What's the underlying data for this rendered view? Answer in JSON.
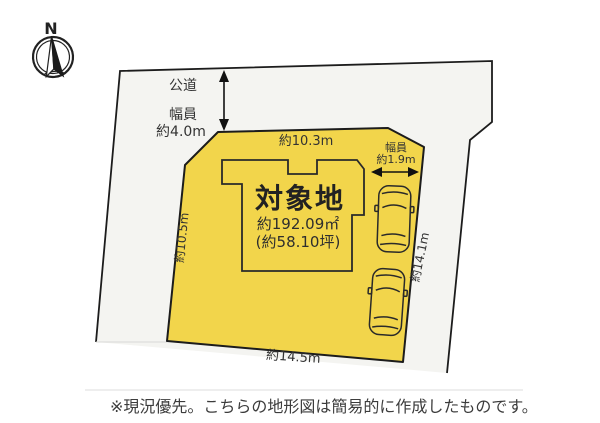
{
  "compass": {
    "north_label": "N"
  },
  "road_top": {
    "name": "公道",
    "width_caption_line1": "幅員",
    "width_caption_line2": "約4.0m"
  },
  "plot": {
    "label": "対象地",
    "area_m2": "約192.09㎡",
    "area_tsubo": "(約58.10坪)",
    "top_dim": "約10.3m",
    "left_dim": "約10.5m",
    "right_dim": "約14.1m",
    "bottom_dim": "約14.5m"
  },
  "side_passage": {
    "width_caption_line1": "幅員",
    "width_caption_line2": "約1.9m"
  },
  "footer": {
    "note": "※現況優先。こちらの地形図は簡易的に作成したものです。"
  },
  "colors": {
    "plot_fill": "#F2D54B",
    "surrounding_fill": "#F4F4F1",
    "line": "#1C1C1C"
  }
}
